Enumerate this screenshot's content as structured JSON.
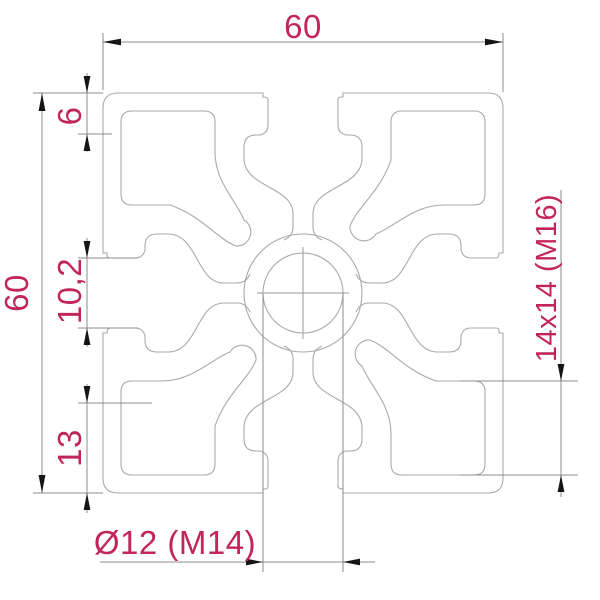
{
  "drawing": {
    "title": "aluminium-extrusion-profile-60x60-cross-section",
    "dim_labels": {
      "top_width": "60",
      "left_height": "60",
      "slot_lip_depth": "6",
      "slot_opening": "10,2",
      "bottom_flange": "13",
      "corner_pocket": "14x14 (M16)",
      "center_bore": "Ø12 (M14)"
    },
    "colors": {
      "dimension_text": "#c2255c",
      "profile_line": "#a9a9a9",
      "dimension_line": "#8c8c8c",
      "arrowhead": "#151515",
      "background": "#ffffff"
    }
  }
}
